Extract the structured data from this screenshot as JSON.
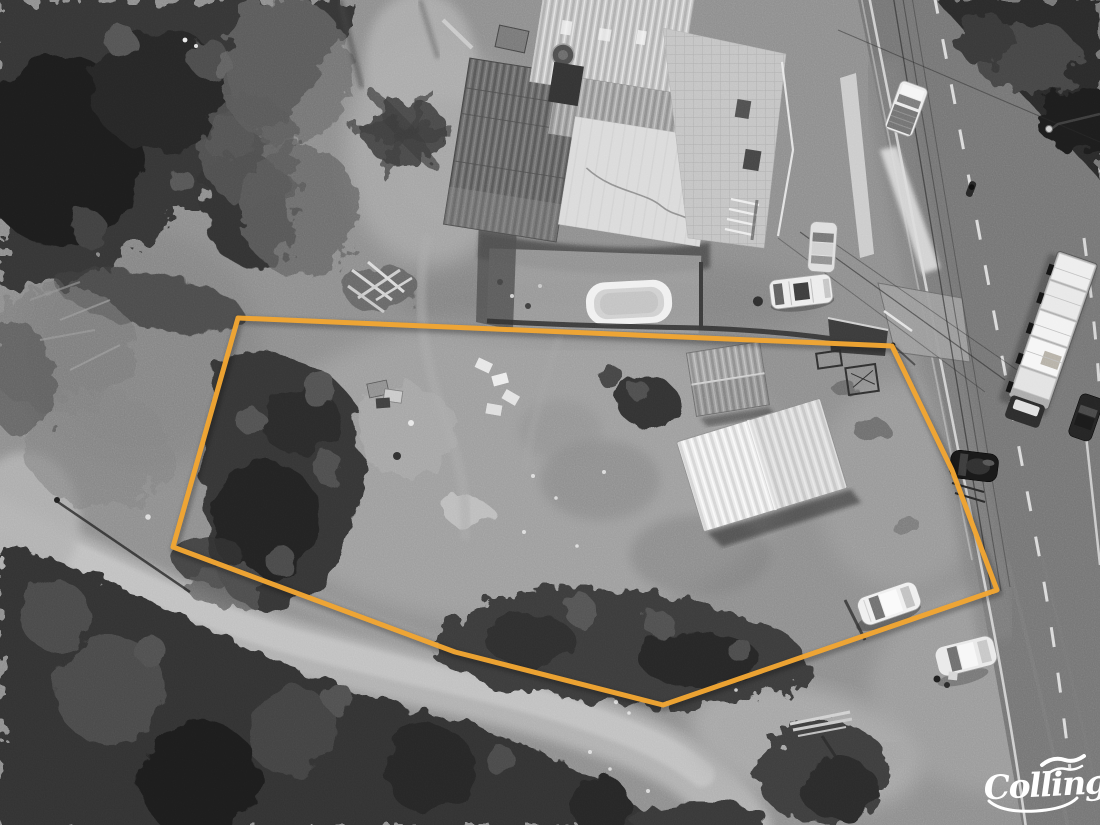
{
  "watermark": {
    "text": "Colling"
  },
  "overlay": {
    "boundary_color": "#F2A633",
    "boundary_stroke_width": 5,
    "boundary_points": [
      [
        238,
        318
      ],
      [
        892,
        346
      ],
      [
        952,
        470
      ],
      [
        997,
        590
      ],
      [
        663,
        705
      ],
      [
        455,
        652
      ],
      [
        173,
        547
      ]
    ]
  }
}
